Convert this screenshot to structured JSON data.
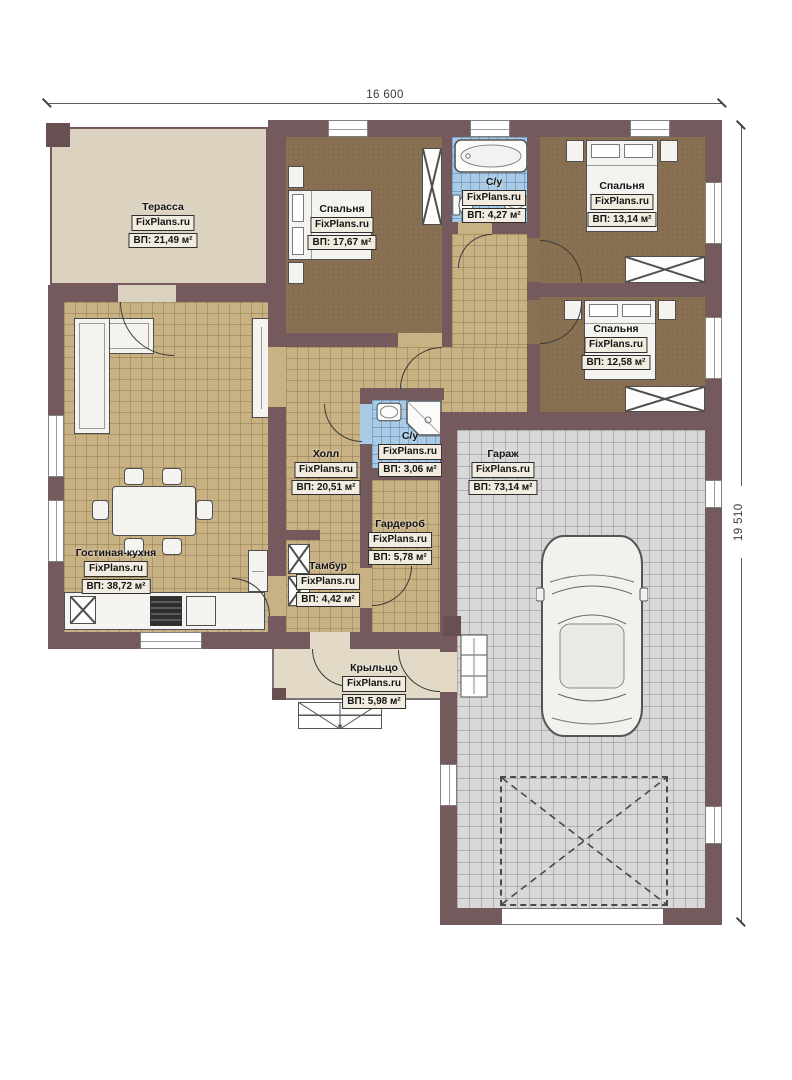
{
  "dims": {
    "width_label": "16 600",
    "height_label": "19 510"
  },
  "watermark": "FixPlans.ru",
  "rooms": {
    "terrace": {
      "name": "Терасса",
      "watermark": "FixPlans.ru",
      "area": "ВП: 21,49 м²"
    },
    "bedroom1": {
      "name": "Спальня",
      "watermark": "FixPlans.ru",
      "area": "ВП: 17,67 м²"
    },
    "bathroom1": {
      "name": "С/у",
      "watermark": "FixPlans.ru",
      "area": "ВП: 4,27 м²"
    },
    "bedroom2": {
      "name": "Спальня",
      "watermark": "FixPlans.ru",
      "area": "ВП: 13,14 м²"
    },
    "bedroom3": {
      "name": "Спальня",
      "watermark": "FixPlans.ru",
      "area": "ВП: 12,58 м²"
    },
    "bathroom2": {
      "name": "С/у",
      "watermark": "FixPlans.ru",
      "area": "ВП: 3,06 м²"
    },
    "hall": {
      "name": "Холл",
      "watermark": "FixPlans.ru",
      "area": "ВП: 20,51 м²"
    },
    "wardrobe": {
      "name": "Гардероб",
      "watermark": "FixPlans.ru",
      "area": "ВП: 5,78 м²"
    },
    "vestibule": {
      "name": "Тамбур",
      "watermark": "FixPlans.ru",
      "area": "ВП: 4,42 м²"
    },
    "living_kitchen": {
      "name": "Гостиная-кухня",
      "watermark": "FixPlans.ru",
      "area": "ВП: 38,72 м²"
    },
    "garage": {
      "name": "Гараж",
      "watermark": "FixPlans.ru",
      "area": "ВП: 73,14 м²"
    },
    "porch": {
      "name": "Крыльцо",
      "watermark": "FixPlans.ru",
      "area": "ВП: 5,98 м²"
    }
  }
}
